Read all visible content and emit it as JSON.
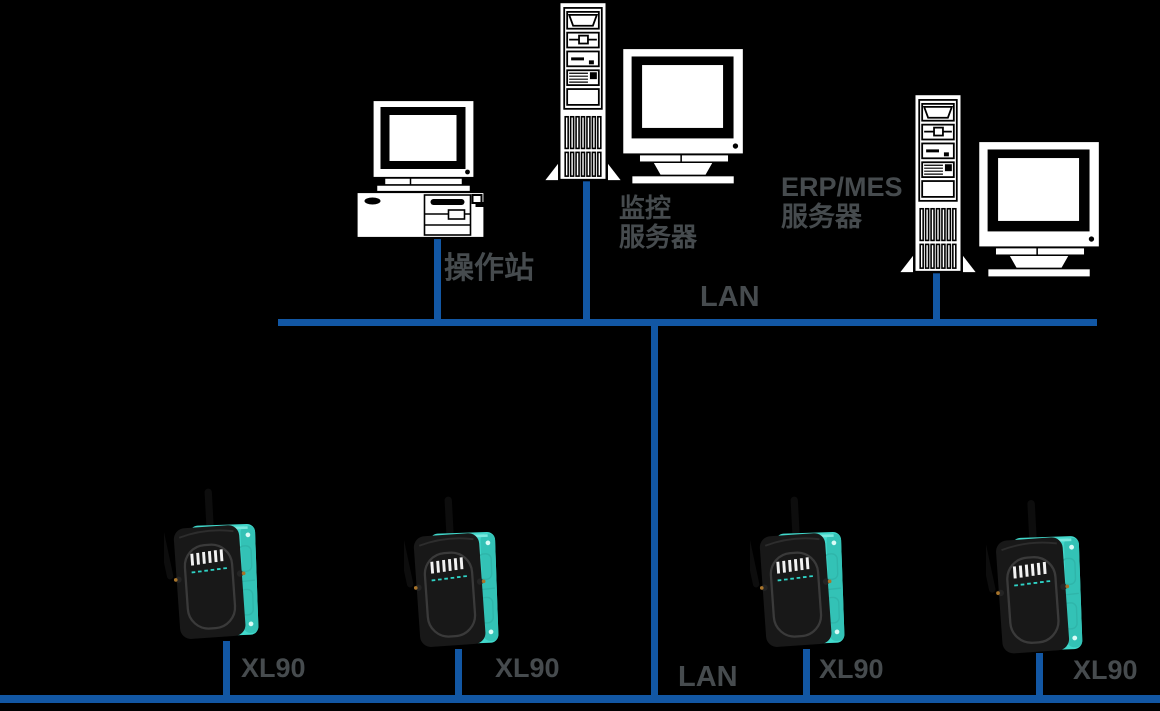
{
  "diagram": {
    "kind": "network-topology",
    "lan_top": {
      "label": "LAN"
    },
    "lan_bottom": {
      "label": "LAN"
    },
    "nodes": {
      "operator_station": {
        "label": "操作站"
      },
      "monitoring_server": {
        "label_line1": "监控",
        "label_line2": "服务器"
      },
      "erp_mes_server": {
        "label_line1": "ERP/MES",
        "label_line2": "服务器"
      },
      "wireless_devices": [
        {
          "label": "XL90"
        },
        {
          "label": "XL90"
        },
        {
          "label": "XL90"
        },
        {
          "label": "XL90"
        }
      ]
    },
    "colors": {
      "background": "#000000",
      "lan_line_blue": "#1257a4",
      "label_gray": "#464b4e",
      "device_teal": "#41d8cb",
      "clipart_white": "#ffffff"
    }
  }
}
